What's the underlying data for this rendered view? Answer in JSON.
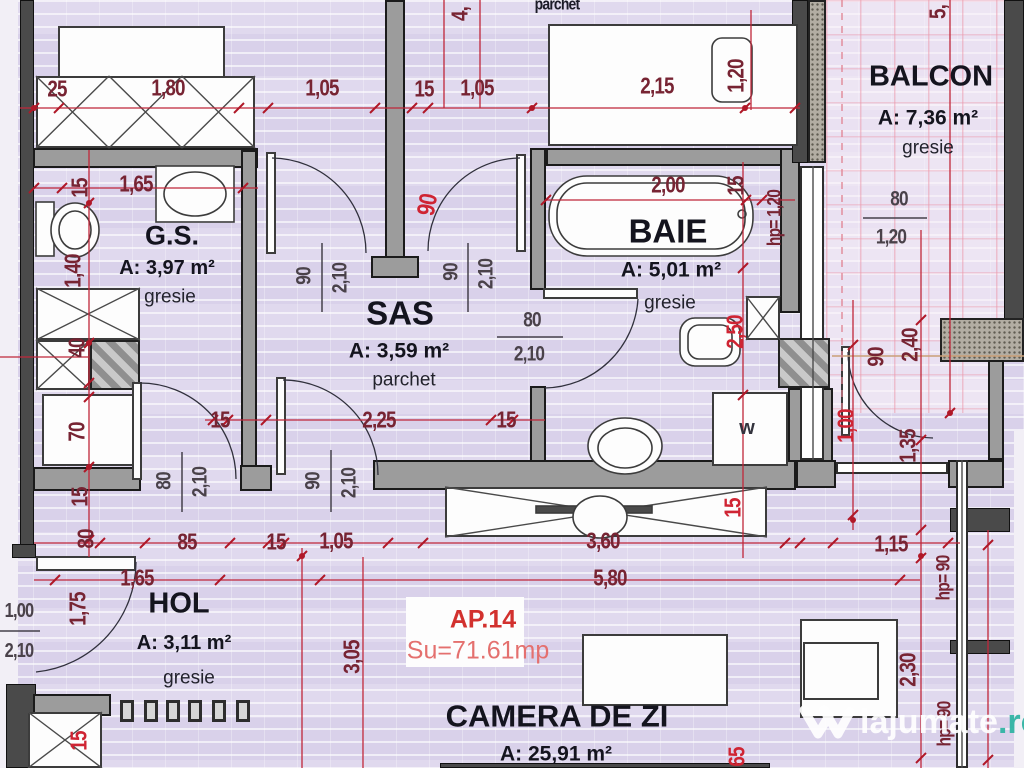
{
  "plan": {
    "apartment": {
      "id": "AP.14",
      "area_label": "Su=71.61mp"
    },
    "rooms": [
      {
        "key": "gs",
        "name": "G.S.",
        "area": "A: 3,97 m²",
        "floor": "gresie"
      },
      {
        "key": "sas",
        "name": "SAS",
        "area": "A: 3,59 m²",
        "floor": "parchet"
      },
      {
        "key": "baie",
        "name": "BAIE",
        "area": "A: 5,01 m²",
        "floor": "gresie"
      },
      {
        "key": "balcon",
        "name": "BALCON",
        "area": "A: 7,36 m²",
        "floor": "gresie"
      },
      {
        "key": "hol",
        "name": "HOL",
        "area": "A: 3,11 m²",
        "floor": "gresie"
      },
      {
        "key": "camera",
        "name": "CAMERA DE ZI",
        "area": "A: 25,91 m²",
        "floor": ""
      }
    ],
    "appliances": {
      "washer": "w"
    },
    "watermark": {
      "brand": "lajumate",
      "tld": ".ro"
    },
    "colors": {
      "dim_maroon": "#772433",
      "dim_red": "#cf2433",
      "dim_dark": "#4a424a",
      "accent_red": "#d2312e",
      "accent_salmon": "#e4706e",
      "wall_gray": "#9c9c9c",
      "floor_lavender": "#d9d1ea",
      "watermark_teal": "#2fb3a3"
    },
    "dimensions": [
      {
        "t": "25",
        "x": 57,
        "y": 89
      },
      {
        "t": "1,80",
        "x": 168,
        "y": 88
      },
      {
        "t": "1,05",
        "x": 322,
        "y": 88
      },
      {
        "t": "15",
        "x": 424,
        "y": 89
      },
      {
        "t": "1,05",
        "x": 477,
        "y": 88
      },
      {
        "t": "2,15",
        "x": 657,
        "y": 86
      },
      {
        "t": "1,20",
        "x": 736,
        "y": 76,
        "r": -90
      },
      {
        "t": "5,",
        "x": 938,
        "y": 12,
        "r": -90
      },
      {
        "t": "4,",
        "x": 460,
        "y": 14,
        "r": -90
      },
      {
        "t": "parchet",
        "x": 557,
        "y": 4,
        "c": "k",
        "s": 17
      },
      {
        "t": "15",
        "x": 80,
        "y": 188,
        "r": -90
      },
      {
        "t": "1,65",
        "x": 136,
        "y": 184
      },
      {
        "t": "2,00",
        "x": 668,
        "y": 185
      },
      {
        "t": "15",
        "x": 736,
        "y": 186,
        "r": -90
      },
      {
        "t": "hp= 1,20",
        "x": 775,
        "y": 218,
        "r": -90,
        "s": 19
      },
      {
        "t": "1,40",
        "x": 73,
        "y": 271,
        "r": -90
      },
      {
        "t": "40",
        "x": 77,
        "y": 348,
        "r": -90
      },
      {
        "t": "70",
        "x": 77,
        "y": 432,
        "r": -90
      },
      {
        "t": "15",
        "x": 80,
        "y": 497,
        "r": -90
      },
      {
        "t": "80",
        "x": 86,
        "y": 539,
        "r": -90
      },
      {
        "t": "90",
        "x": 304,
        "y": 276,
        "r": -90,
        "c": "d",
        "s": 21
      },
      {
        "t": "2,10",
        "x": 340,
        "y": 278,
        "r": -90,
        "c": "d",
        "s": 21
      },
      {
        "t": "90",
        "x": 451,
        "y": 272,
        "r": -90,
        "c": "d",
        "s": 21
      },
      {
        "t": "2,10",
        "x": 486,
        "y": 274,
        "r": -90,
        "c": "d",
        "s": 21
      },
      {
        "t": "90",
        "x": 428,
        "y": 205,
        "r": -80,
        "c": "r",
        "s": 25
      },
      {
        "t": "80",
        "x": 532,
        "y": 320,
        "c": "d",
        "s": 21
      },
      {
        "t": "2,10",
        "x": 529,
        "y": 354,
        "c": "d",
        "s": 21
      },
      {
        "t": "90",
        "x": 313,
        "y": 481,
        "r": -90,
        "c": "d",
        "s": 21
      },
      {
        "t": "2,10",
        "x": 349,
        "y": 483,
        "r": -90,
        "c": "d",
        "s": 21
      },
      {
        "t": "80",
        "x": 164,
        "y": 481,
        "r": -90,
        "c": "d",
        "s": 21
      },
      {
        "t": "2,10",
        "x": 200,
        "y": 482,
        "r": -90,
        "c": "d",
        "s": 21
      },
      {
        "t": "15",
        "x": 220,
        "y": 420
      },
      {
        "t": "2,25",
        "x": 379,
        "y": 420
      },
      {
        "t": "15",
        "x": 506,
        "y": 420
      },
      {
        "t": "2,50",
        "x": 735,
        "y": 332,
        "r": -90,
        "c": "r"
      },
      {
        "t": "90",
        "x": 876,
        "y": 357,
        "r": -90
      },
      {
        "t": "2,40",
        "x": 910,
        "y": 345,
        "r": -90
      },
      {
        "t": "1,00",
        "x": 846,
        "y": 426,
        "r": -90,
        "c": "r"
      },
      {
        "t": "1,35",
        "x": 908,
        "y": 446,
        "r": -90
      },
      {
        "t": "80",
        "x": 899,
        "y": 199,
        "c": "d",
        "s": 21
      },
      {
        "t": "1,20",
        "x": 891,
        "y": 237,
        "c": "d",
        "s": 21
      },
      {
        "t": "85",
        "x": 187,
        "y": 542
      },
      {
        "t": "15",
        "x": 276,
        "y": 542
      },
      {
        "t": "1,05",
        "x": 336,
        "y": 541
      },
      {
        "t": "3,60",
        "x": 603,
        "y": 541
      },
      {
        "t": "15",
        "x": 733,
        "y": 508,
        "r": -90,
        "c": "r"
      },
      {
        "t": "1,15",
        "x": 891,
        "y": 544
      },
      {
        "t": "1,65",
        "x": 137,
        "y": 578
      },
      {
        "t": "5,80",
        "x": 610,
        "y": 578
      },
      {
        "t": "1,75",
        "x": 78,
        "y": 609,
        "r": -90
      },
      {
        "t": "1,00",
        "x": 19,
        "y": 611,
        "c": "d",
        "s": 20
      },
      {
        "t": "2,10",
        "x": 19,
        "y": 651,
        "c": "d",
        "s": 20
      },
      {
        "t": "3,05",
        "x": 352,
        "y": 657,
        "r": -90
      },
      {
        "t": "2,30",
        "x": 908,
        "y": 670,
        "r": -90
      },
      {
        "t": "hp= 90",
        "x": 944,
        "y": 578,
        "r": -90,
        "s": 19
      },
      {
        "t": "hp= 90",
        "x": 945,
        "y": 724,
        "r": -90,
        "s": 19
      },
      {
        "t": "65",
        "x": 737,
        "y": 757,
        "r": -90,
        "c": "r"
      },
      {
        "t": "15",
        "x": 79,
        "y": 741,
        "r": -90,
        "c": "r"
      }
    ]
  }
}
